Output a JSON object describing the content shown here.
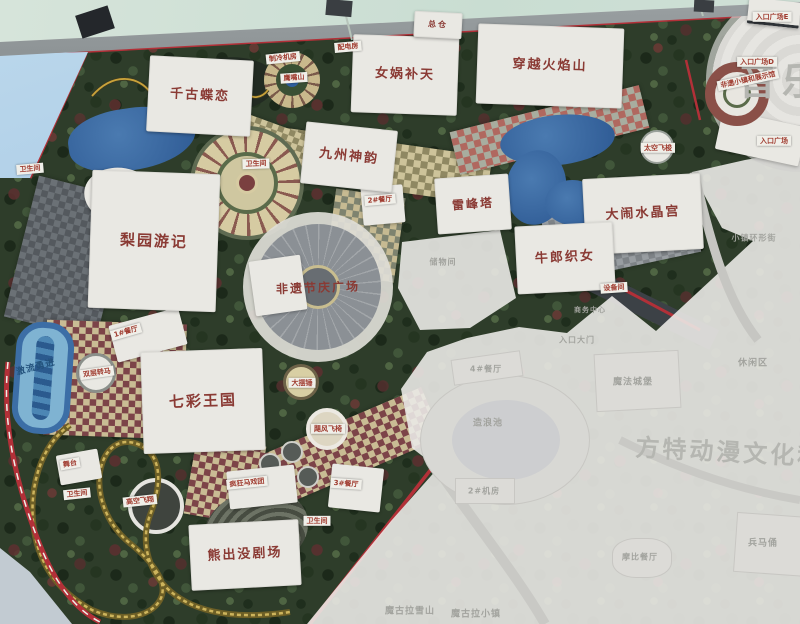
{
  "map": {
    "plaza_label": "非遗节庆广场",
    "attraction_blocks": [
      {
        "label": "千古蝶恋",
        "x": 148,
        "y": 58,
        "w": 104,
        "h": 76,
        "rot": 3,
        "fs": 13
      },
      {
        "label": "女娲补天",
        "x": 352,
        "y": 36,
        "w": 106,
        "h": 78,
        "rot": 2,
        "fs": 13
      },
      {
        "label": "穿越火焰山",
        "x": 477,
        "y": 26,
        "w": 146,
        "h": 80,
        "rot": 2,
        "fs": 13
      },
      {
        "label": "总仓",
        "x": 414,
        "y": 12,
        "w": 48,
        "h": 26,
        "rot": 3,
        "fs": 8
      },
      {
        "label": "九州神韵",
        "x": 303,
        "y": 126,
        "w": 92,
        "h": 62,
        "rot": 6,
        "fs": 13
      },
      {
        "label": "雷峰塔",
        "x": 436,
        "y": 176,
        "w": 74,
        "h": 56,
        "rot": -4,
        "fs": 12
      },
      {
        "label": "大闹水晶宫",
        "x": 584,
        "y": 176,
        "w": 118,
        "h": 76,
        "rot": -3,
        "fs": 13
      },
      {
        "label": "牛郎织女",
        "x": 516,
        "y": 224,
        "w": 98,
        "h": 68,
        "rot": -3,
        "fs": 13
      },
      {
        "label": "梨园游记",
        "x": 90,
        "y": 172,
        "w": 128,
        "h": 138,
        "rot": 2,
        "fs": 15
      },
      {
        "label": "七彩王国",
        "x": 142,
        "y": 350,
        "w": 122,
        "h": 102,
        "rot": -2,
        "fs": 15
      },
      {
        "label": "熊出没剧场",
        "x": 190,
        "y": 522,
        "w": 110,
        "h": 66,
        "rot": -3,
        "fs": 13
      }
    ],
    "facility_labels": [
      {
        "label": "制冷机房",
        "x": 283,
        "y": 58,
        "rot": -6
      },
      {
        "label": "配电房",
        "x": 348,
        "y": 47,
        "rot": -5
      },
      {
        "label": "鹰嘴山",
        "x": 294,
        "y": 78,
        "rot": -4
      },
      {
        "label": "卫生间",
        "x": 30,
        "y": 169,
        "rot": -5
      },
      {
        "label": "卫生间",
        "x": 256,
        "y": 164,
        "rot": -2
      },
      {
        "label": "2#餐厅",
        "x": 380,
        "y": 200,
        "rot": -5
      },
      {
        "label": "1#餐厅",
        "x": 126,
        "y": 332,
        "rot": -16
      },
      {
        "label": "双层转马",
        "x": 97,
        "y": 373,
        "rot": -8
      },
      {
        "label": "激流勇进",
        "x": 36,
        "y": 368,
        "rot": -15,
        "style": "water"
      },
      {
        "label": "大摆锤",
        "x": 302,
        "y": 383,
        "rot": 0
      },
      {
        "label": "飓风飞椅",
        "x": 328,
        "y": 429,
        "rot": 0
      },
      {
        "label": "舞台",
        "x": 70,
        "y": 464,
        "rot": -10
      },
      {
        "label": "卫生间",
        "x": 77,
        "y": 494,
        "rot": -6
      },
      {
        "label": "高空飞翔",
        "x": 140,
        "y": 501,
        "rot": -6
      },
      {
        "label": "疯狂马戏团",
        "x": 247,
        "y": 483,
        "rot": -6
      },
      {
        "label": "3#餐厅",
        "x": 346,
        "y": 484,
        "rot": 4
      },
      {
        "label": "卫生间",
        "x": 317,
        "y": 521,
        "rot": 0
      },
      {
        "label": "太空飞梭",
        "x": 658,
        "y": 148,
        "rot": 0
      },
      {
        "label": "设备间",
        "x": 614,
        "y": 288,
        "rot": -4
      },
      {
        "label": "非遗小镇和展示馆",
        "x": 748,
        "y": 80,
        "rot": -12
      },
      {
        "label": "入口广场E",
        "x": 772,
        "y": 17,
        "rot": 0
      },
      {
        "label": "入口广场D",
        "x": 757,
        "y": 62,
        "rot": 0
      },
      {
        "label": "入口广场",
        "x": 774,
        "y": 141,
        "rot": 0
      }
    ],
    "faded_labels": [
      {
        "label": "储物间",
        "x": 443,
        "y": 262,
        "fs": 8
      },
      {
        "label": "小镇环形街",
        "x": 754,
        "y": 238,
        "fs": 8
      },
      {
        "label": "商务中心",
        "x": 590,
        "y": 310,
        "fs": 7
      },
      {
        "label": "入口大门",
        "x": 577,
        "y": 340,
        "fs": 8
      },
      {
        "label": "4#餐厅",
        "x": 486,
        "y": 369,
        "fs": 8
      },
      {
        "label": "造浪池",
        "x": 488,
        "y": 422,
        "fs": 9
      },
      {
        "label": "2#机房",
        "x": 484,
        "y": 491,
        "fs": 8
      },
      {
        "label": "魔法城堡",
        "x": 633,
        "y": 381,
        "fs": 9
      },
      {
        "label": "休闲区",
        "x": 753,
        "y": 362,
        "fs": 9
      },
      {
        "label": "兵马俑",
        "x": 763,
        "y": 542,
        "fs": 9
      },
      {
        "label": "摩比餐厅",
        "x": 640,
        "y": 557,
        "fs": 8
      },
      {
        "label": "魔古拉雪山",
        "x": 410,
        "y": 610,
        "fs": 9
      },
      {
        "label": "魔古拉小镇",
        "x": 476,
        "y": 613,
        "fs": 9
      }
    ],
    "watermarks": [
      {
        "text": "音乐",
        "x": 782,
        "y": 78,
        "fs": 38,
        "ls": 6,
        "rot": 0
      },
      {
        "text": "方特动漫文化科",
        "x": 730,
        "y": 450,
        "fs": 24,
        "ls": 3,
        "rot": 3
      }
    ],
    "colors": {
      "label_red": "#8a3a34",
      "boundary_red": "#b23038",
      "water_blue": "#2f5f9e",
      "path_tan": "#cdc39a",
      "path_maroon": "#7c4448",
      "tree_green": "#2e3d2a",
      "faded_bg": "#eae9e5",
      "coaster_gold": "#c9b45c"
    }
  }
}
